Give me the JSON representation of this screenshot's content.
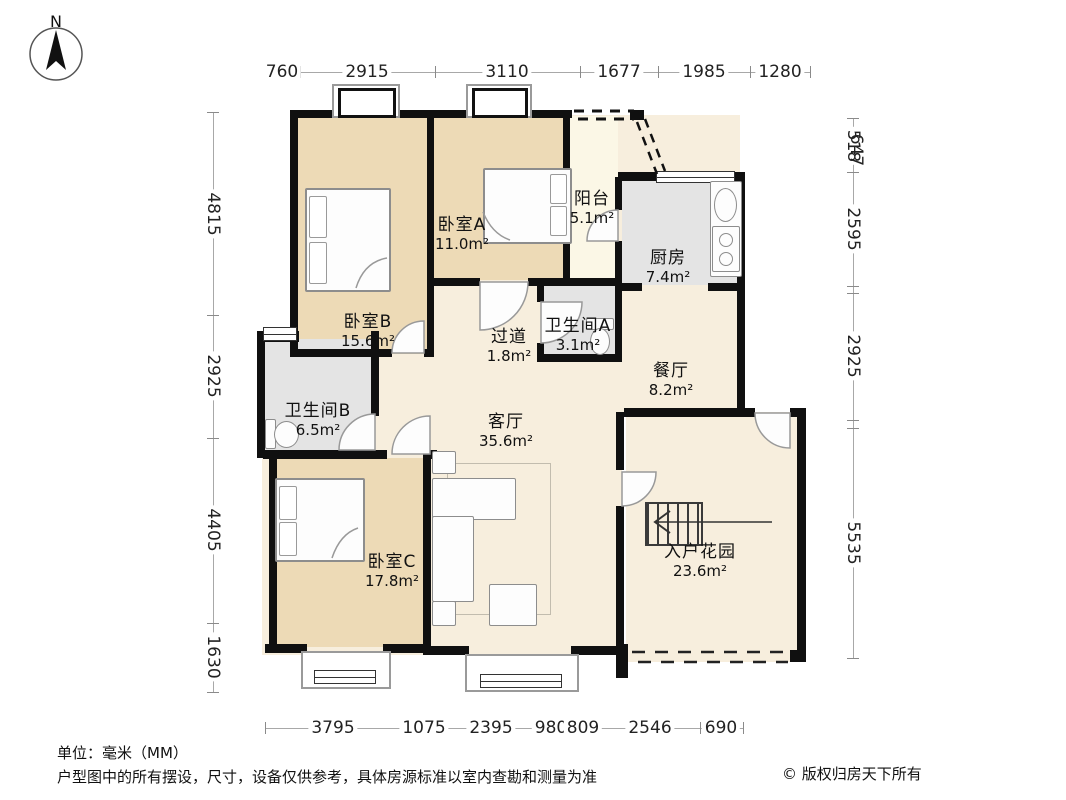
{
  "compass": {
    "label": "N"
  },
  "rooms": [
    {
      "name": "卧室B",
      "area": "15.6m²"
    },
    {
      "name": "卧室A",
      "area": "11.0m²"
    },
    {
      "name": "阳台",
      "area": "5.1m²"
    },
    {
      "name": "厨房",
      "area": "7.4m²"
    },
    {
      "name": "过道",
      "area": "1.8m²"
    },
    {
      "name": "卫生间A",
      "area": "3.1m²"
    },
    {
      "name": "餐厅",
      "area": "8.2m²"
    },
    {
      "name": "卫生间B",
      "area": "6.5m²"
    },
    {
      "name": "客厅",
      "area": "35.6m²"
    },
    {
      "name": "卧室C",
      "area": "17.8m²"
    },
    {
      "name": "入户花园",
      "area": "23.6m²"
    }
  ],
  "dims": {
    "top": [
      "760",
      "2915",
      "3110",
      "1677",
      "1985",
      "1280"
    ],
    "left": [
      "4815",
      "2925",
      "4405",
      "1630"
    ],
    "right": [
      "518",
      "647",
      "2595",
      "2925",
      "5535"
    ],
    "bottom": [
      "3795",
      "1075",
      "2395",
      "980",
      "809",
      "2546",
      "690"
    ]
  },
  "footer": {
    "unit": "单位：毫米（MM）",
    "disclaimer": "户型图中的所有摆设，尺寸，设备仅供参考，具体房源标准以室内查勘和测量为准",
    "copyright": "© 版权归房天下所有"
  },
  "colors": {
    "wall": "#101010",
    "bedroom_fill": "#eddab6",
    "public_fill": "#f7eedd",
    "wet_fill": "#e4e4e4",
    "balcony_fill": "#fbf7e6"
  }
}
